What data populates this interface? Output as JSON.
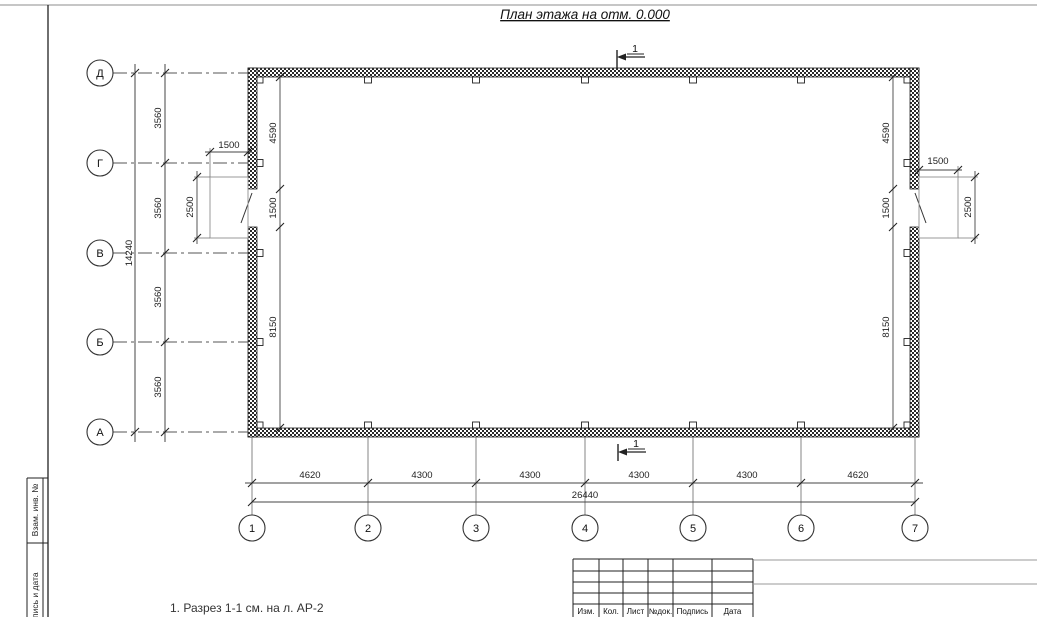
{
  "title": "План этажа на отм. 0.000",
  "axes": {
    "rows": [
      "Д",
      "Г",
      "В",
      "Б",
      "А"
    ],
    "cols": [
      "1",
      "2",
      "3",
      "4",
      "5",
      "6",
      "7"
    ]
  },
  "dims": {
    "row_spans": [
      "3560",
      "3560",
      "3560",
      "3560"
    ],
    "row_total": "14240",
    "col_spans": [
      "4620",
      "4300",
      "4300",
      "4300",
      "4300",
      "4620"
    ],
    "col_total": "26440",
    "left_chain": [
      "4590",
      "1500",
      "8150"
    ],
    "right_chain": [
      "4590",
      "1500",
      "8150"
    ],
    "left_porch_w": "1500",
    "left_porch_h": "2500",
    "right_porch_w": "1500",
    "right_porch_h": "2500"
  },
  "section": {
    "top": "1",
    "bottom": "1"
  },
  "note": "1. Разрез 1-1 см. на л. АР-2",
  "titleblock": {
    "headers": [
      "Изм.",
      "Кол.",
      "Лист",
      "№док.",
      "Подпись",
      "Дата"
    ]
  },
  "sidestrip": {
    "upper": "Взам. инв. №",
    "lower": "Подпись и дата"
  },
  "colors": {
    "line": "#222222",
    "aux": "#666666",
    "porch": "#999999",
    "frame_top": "#b3b3b3"
  }
}
